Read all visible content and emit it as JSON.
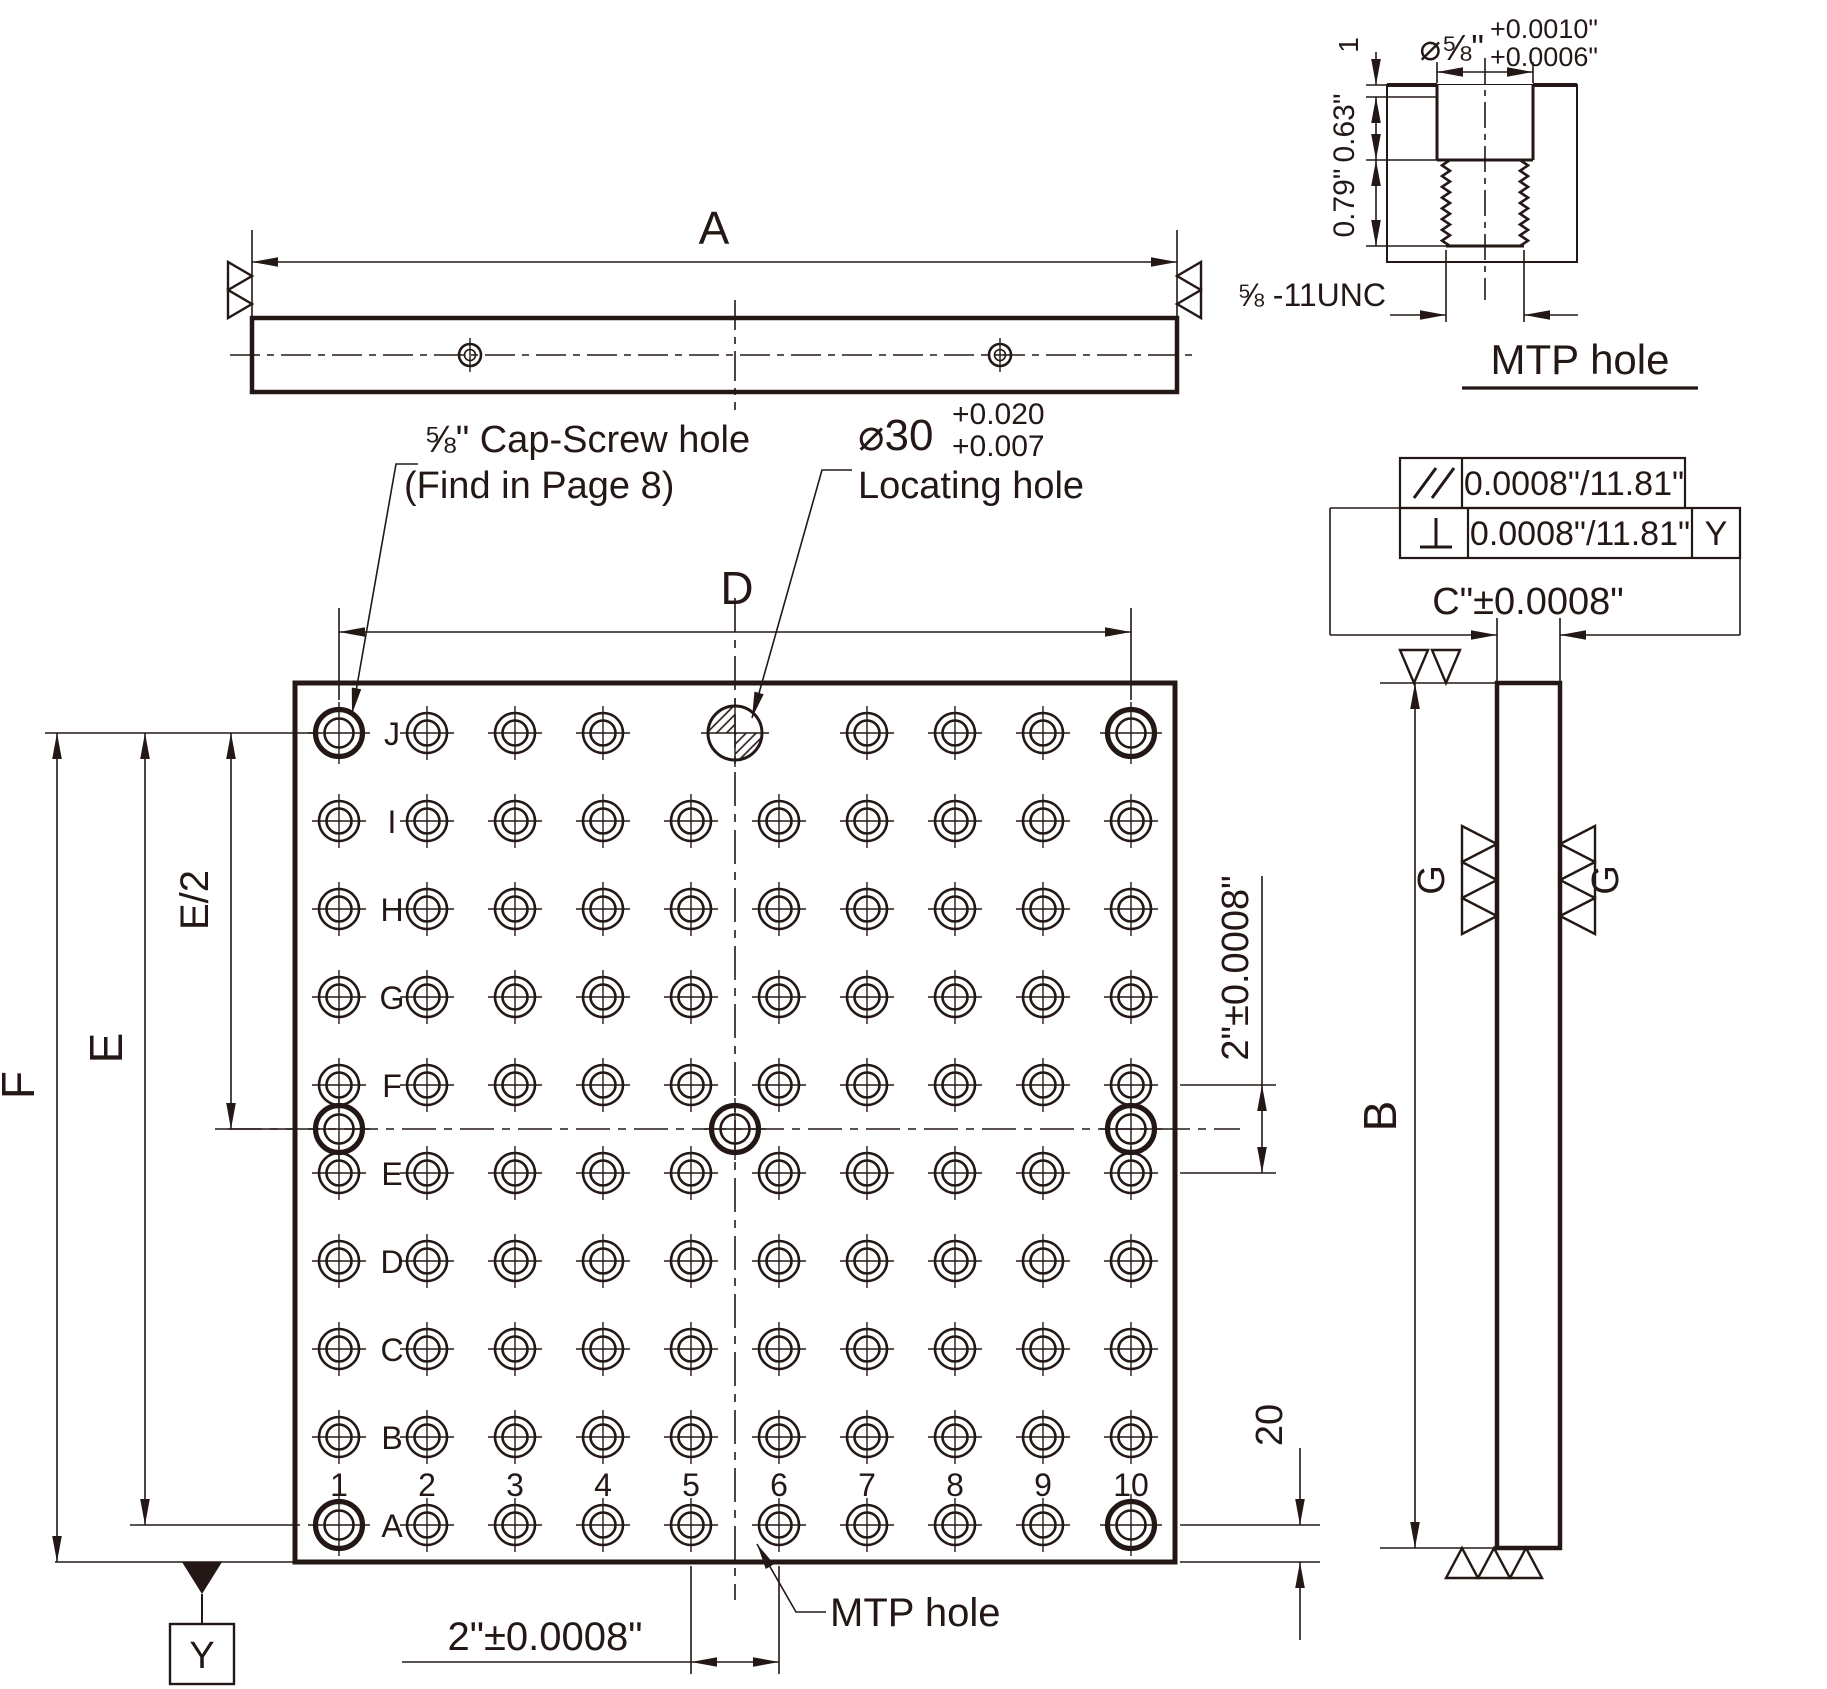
{
  "labels": {
    "top": {
      "a": "A"
    },
    "plan": {
      "d": "D",
      "e": "E",
      "e2": "E/2",
      "f": "F",
      "two_h": "2\"±0.0008\"",
      "two_v": "2\"±0.0008\"",
      "twenty": "20",
      "cap_line1": "⅝\" Cap-Screw hole",
      "cap_line2": "(Find in Page 8)",
      "loc_dia": "⌀30",
      "loc_tol_up": "+0.020",
      "loc_tol_lo": "+0.007",
      "loc_name": "Locating hole",
      "mtp": "MTP hole",
      "datum_y": "Y"
    },
    "side": {
      "b": "B",
      "c": "C\"±0.0008\"",
      "g_left": "G",
      "g_right": "G"
    },
    "frames": {
      "parallel_value": "0.0008\"/11.81\"",
      "perp_value": "0.0008\"/11.81\"",
      "datum": "Y"
    },
    "detail": {
      "title": "MTP hole",
      "dia": "⌀⅝\"",
      "tol_up": "+0.0010\"",
      "tol_lo": "+0.0006\"",
      "d1": "1",
      "d63": "0.63\"",
      "d79": "0.79\"",
      "thread": "⅝ -11UNC"
    }
  },
  "grid": {
    "row_labels": [
      "J",
      "I",
      "H",
      "G",
      "F",
      "E",
      "D",
      "C",
      "B",
      "A"
    ],
    "col_labels": [
      "1",
      "2",
      "3",
      "4",
      "5",
      "6",
      "7",
      "8",
      "9",
      "10"
    ],
    "hole_types": {
      "regular": "MTP tapped hole",
      "cap": "cap-screw hole",
      "locating": "locating hole"
    }
  },
  "colors": {
    "line": "#231815",
    "plate_fill": "#e9e8e6"
  }
}
